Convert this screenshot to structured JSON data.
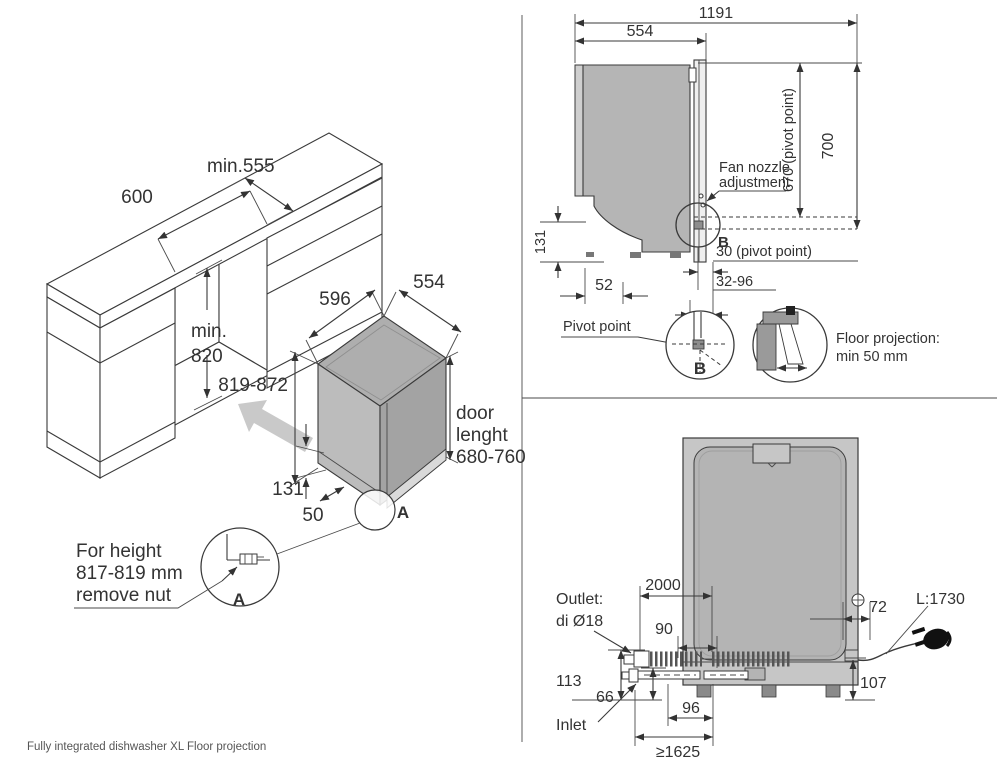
{
  "footer": {
    "caption": "Fully integrated dishwasher XL Floor projection"
  },
  "cabinet": {
    "niche_width": "600",
    "niche_depth": "min.555",
    "niche_height_line1": "min.",
    "niche_height_line2": "820"
  },
  "dishwasher_iso": {
    "width": "596",
    "depth": "554",
    "height": "819-872",
    "door_line1": "door",
    "door_line2": "lenght",
    "door_line3": "680-760",
    "plinth_height": "131",
    "plinth_inset": "50",
    "corner_marker": "A"
  },
  "detail_a": {
    "note_line1": "For height",
    "note_line2": "817-819 mm",
    "note_line3": "remove nut",
    "marker": "A"
  },
  "side_view": {
    "total_depth_open": "1191",
    "body_depth": "554",
    "door_top_height": "700",
    "pivot_height": "670 (pivot point)",
    "fan_line1": "Fan nozzle",
    "fan_line2": "adjustment",
    "detail_marker": "B",
    "pivot_offset": "30 (pivot point)",
    "toe_range": "32-96",
    "plinth_height": "131",
    "rear_offset": "52"
  },
  "pivot_detail": {
    "label": "Pivot point",
    "marker": "B"
  },
  "floor_detail": {
    "line1": "Floor projection:",
    "line2": "min 50 mm"
  },
  "rear_view": {
    "drain_hose_length": "2000",
    "outlet_offset": "90",
    "cord_offset": "72",
    "cord_length": "L:1730",
    "outlet_height": "113",
    "inlet_height": "66",
    "cord_height": "107",
    "inlet_offset": "96",
    "hose_reach": "≥1625",
    "outlet_line1": "Outlet:",
    "outlet_line2": "di Ø18",
    "inlet_label": "Inlet"
  }
}
